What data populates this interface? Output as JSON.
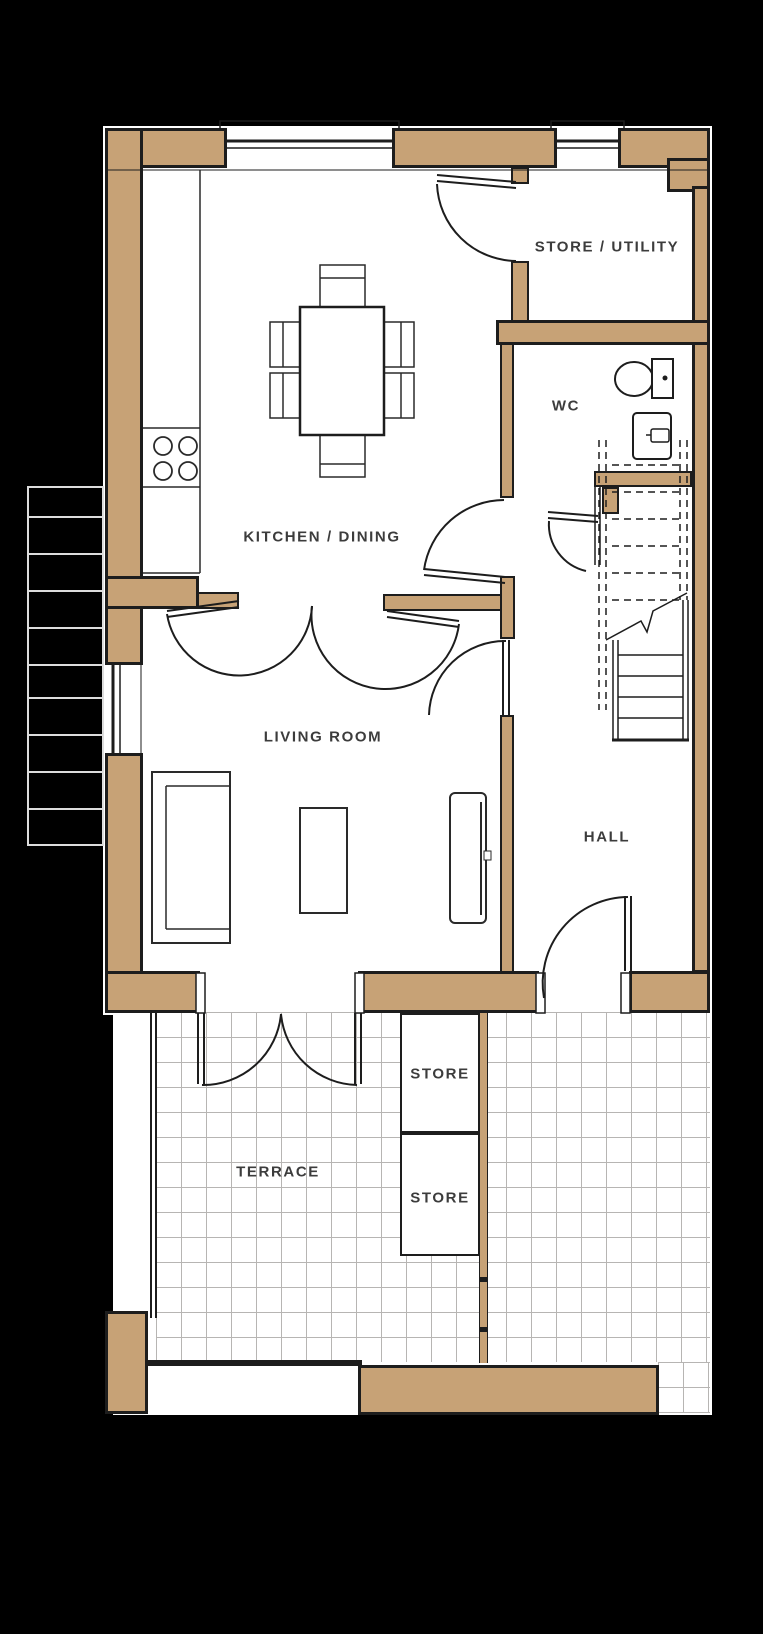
{
  "floorplan": {
    "rooms": [
      {
        "id": "store-utility",
        "label": "STORE / UTILITY"
      },
      {
        "id": "wc",
        "label": "WC"
      },
      {
        "id": "kitchen-dining",
        "label": "KITCHEN / DINING"
      },
      {
        "id": "living-room",
        "label": "LIVING ROOM"
      },
      {
        "id": "hall",
        "label": "HALL"
      },
      {
        "id": "store-upper",
        "label": "STORE"
      },
      {
        "id": "store-lower",
        "label": "STORE"
      },
      {
        "id": "terrace",
        "label": "TERRACE"
      }
    ],
    "colors": {
      "background": "#000000",
      "wall_fill": "#c7a276",
      "line_ink": "#1d1d1d",
      "label_text": "#3c3c3c",
      "grid_line": "#b7b5b3",
      "floor": "#ffffff",
      "exterior_step_line": "#dcdcdc"
    },
    "fixtures": [
      "dining-table",
      "dining-chair",
      "hob",
      "kitchen-counter",
      "sofa",
      "coffee-table",
      "tv-unit",
      "toilet",
      "basin",
      "staircase",
      "stair-direction-arrow",
      "external-steps",
      "terrace-paving",
      "window",
      "door-swing"
    ]
  }
}
